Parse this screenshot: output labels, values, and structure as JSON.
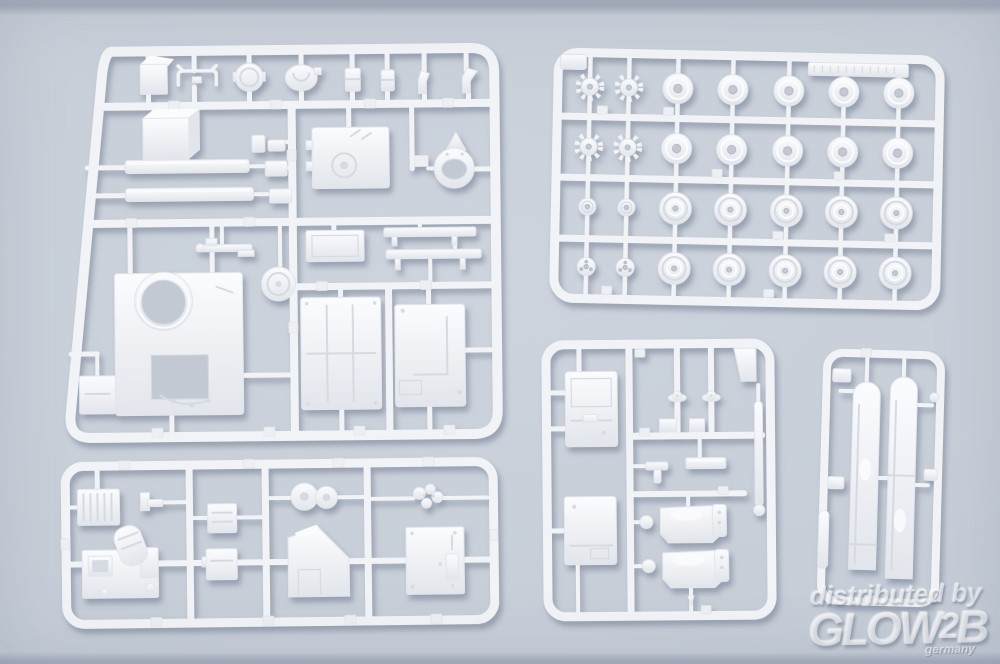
{
  "meta": {
    "description": "Product photo: five white injection-molded plastic model-kit sprues (tank parts: hull plates, hatches, road wheels, sprockets, fenders, fuel tanks, tools) laid on a light blue-grey background",
    "sprues": [
      "hull-parts-sprue-top-left",
      "road-wheels-sprue-top-right",
      "small-parts-sprue-bottom-middle",
      "fenders-sprue-bottom-right",
      "tools-sprue-bottom-left"
    ]
  },
  "colors": {
    "bg_hi": "#cdd4dd",
    "bg": "#c7ced8",
    "bg_lo": "#bec6d2",
    "bg_top_edge": "#a6aebd",
    "bg_bottom_edge": "#a5aebc",
    "plastic": "#f2f3f6",
    "plastic_hi": "#fbfcfe",
    "plastic_lo": "#e2e5eb",
    "detail": "#d6dae1",
    "hole": "#c3c9d3",
    "tab": "#edeff3",
    "shadow": "rgba(104,114,136,0.5)",
    "watermark": "rgba(255,255,255,0.58)"
  },
  "watermark": {
    "line1": "distributed by",
    "logo_main": "GLOW",
    "logo_digit": "2",
    "logo_suffix": "B",
    "country": "germany"
  }
}
